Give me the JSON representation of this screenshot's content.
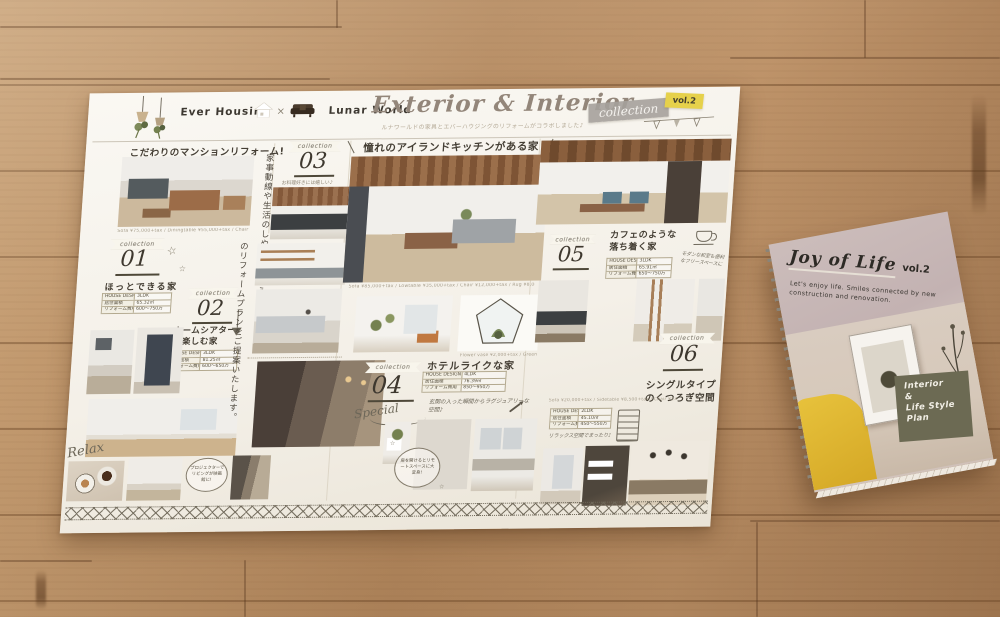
{
  "common": {
    "ribbon": "collection"
  },
  "header": {
    "brand_left": "Ever Housing",
    "multiply": "×",
    "brand_right": "Lunar World",
    "title": "Exterior & Interior",
    "subtitle": "ルナワールドの家具とエバーハウジングのリフォームがコラボしました♪",
    "tape_collection": "collection",
    "tape_vol": "vol.2"
  },
  "left": {
    "headline": "こだわりのマンションリフォーム!",
    "caption_prices": "Sofa ¥75,000+tax / Diningtable ¥55,000+tax / Chair ¥6,000+tax / Bench ¥8,000+tax",
    "sec01": {
      "no": "01",
      "title": "ほっとできる家",
      "specs": [
        {
          "label": "HOUSE DESIGN",
          "value": "3LDK"
        },
        {
          "label": "居住面積",
          "value": "65.32㎡"
        },
        {
          "label": "リフォーム費用",
          "value": "600〜750万"
        }
      ]
    },
    "sec02": {
      "no": "02",
      "title": "ホームシアターを楽しむ家",
      "specs": [
        {
          "label": "HOUSE DESIGN",
          "value": "3LDK"
        },
        {
          "label": "専有面積",
          "value": "81.25㎡"
        },
        {
          "label": "リフォーム費用",
          "value": "600〜650万"
        }
      ]
    },
    "relax": "Relax",
    "bubble": "プロジェクターでリビングが映画館に!"
  },
  "vertical": {
    "line1": "家事動線や生活のしやすさを考えたこだわり",
    "line2": "のリフォームプランをご提案いたします。"
  },
  "col3": {
    "no": "03",
    "note": "お料理好きには嬉しい♪"
  },
  "center": {
    "headline": "憧れのアイランドキッチンがある家",
    "caption_prices": "Sofa ¥85,000+tax / Lowtable ¥35,000+tax / Chair ¥12,000+tax / Rug ¥8,000+tax",
    "terrarium_caption": "Flower vase ¥2,000+tax / Green ¥1,000+tax",
    "sec04": {
      "no": "04",
      "title": "ホテルライクな家",
      "hand": "Special",
      "specs": [
        {
          "label": "HOUSE DESIGN",
          "value": "4LDK"
        },
        {
          "label": "居住面積",
          "value": "76.39㎡"
        },
        {
          "label": "リフォーム費用",
          "value": "850〜950万"
        }
      ],
      "note": "玄関の入った瞬間からラグジュアリーな空間♪"
    },
    "bubble": "扉を開けるとリモートスペースに大変身!"
  },
  "right": {
    "sec05": {
      "no": "05",
      "title": "カフェのような落ち着く家",
      "specs": [
        {
          "label": "HOUSE DESIGN",
          "value": "3LDK"
        },
        {
          "label": "居住面積",
          "value": "65.91㎡"
        },
        {
          "label": "リフォーム費用",
          "value": "650〜750万"
        }
      ],
      "note": "モダンな和室も便利なフリースペースに"
    },
    "caption_prices": "Sofa ¥20,000+tax / Sidetable ¥8,500+tax / Chair ¥23,000+tax",
    "sec06": {
      "no": "06",
      "title": "シングルタイプのくつろぎ空間",
      "specs": [
        {
          "label": "HOUSE DESIGN",
          "value": "2LDK"
        },
        {
          "label": "居住面積",
          "value": "45.10㎡"
        },
        {
          "label": "リフォーム費用",
          "value": "450〜550万"
        }
      ],
      "note": "リラックス空間でまったり♪"
    }
  },
  "booklet": {
    "title": "Joy of Life",
    "vol": "vol.2",
    "subtitle": "Let's enjoy life. Smiles connected by new construction and renovation.",
    "badge_lines": [
      "Interior",
      "&",
      "Life Style",
      "Plan"
    ]
  },
  "colors": {
    "tape_yellow": "#e6d14b",
    "tape_grey": "#a5a19b",
    "badge_olive": "#6c6a53",
    "paper": "#f7f4ee",
    "wood": "#b98f68"
  }
}
